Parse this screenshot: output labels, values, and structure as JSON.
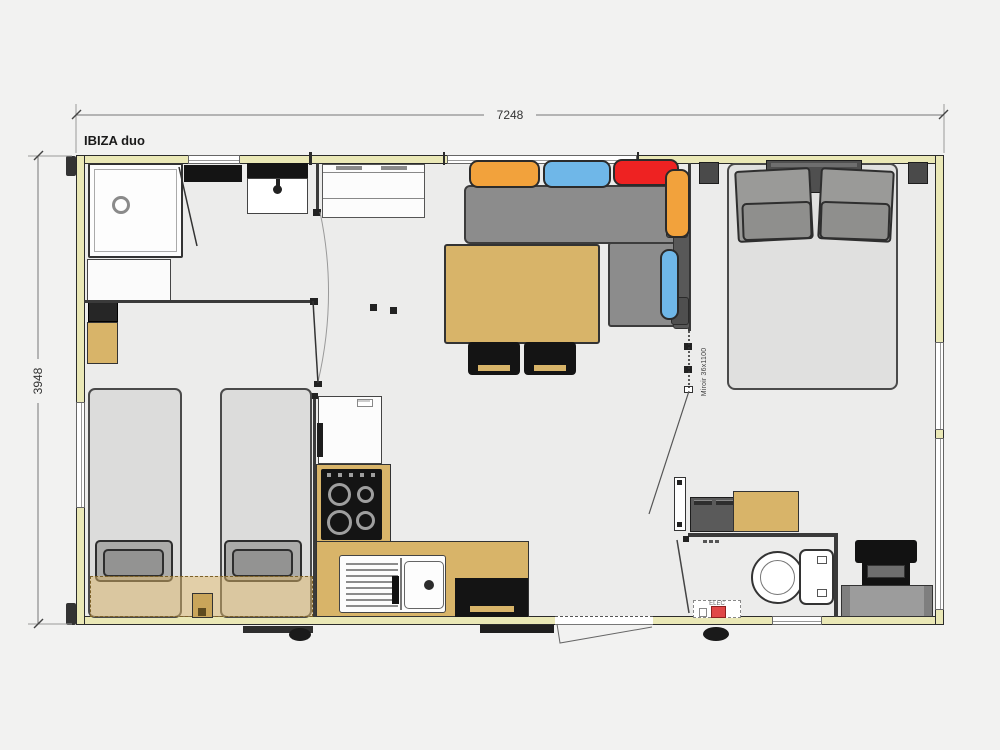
{
  "header": {
    "title": "IBIZA duo"
  },
  "dimensions": {
    "width_mm": "7248",
    "height_mm": "3948"
  },
  "labels": {
    "mirror": "Miroir 36x1100",
    "elec": "ELEC"
  },
  "colors": {
    "wall_fill": "#eae8b6",
    "floor": "#ececeb",
    "counter_tan": "#d8b469",
    "sofa_gray": "#8c8c8c",
    "cushion_orange": "#f2a23c",
    "cushion_blue": "#6fb7e8",
    "cushion_red": "#ee2222",
    "appliance_black": "#141414",
    "bed_gray": "#dcdcdb",
    "elec_red": "#e04747"
  }
}
